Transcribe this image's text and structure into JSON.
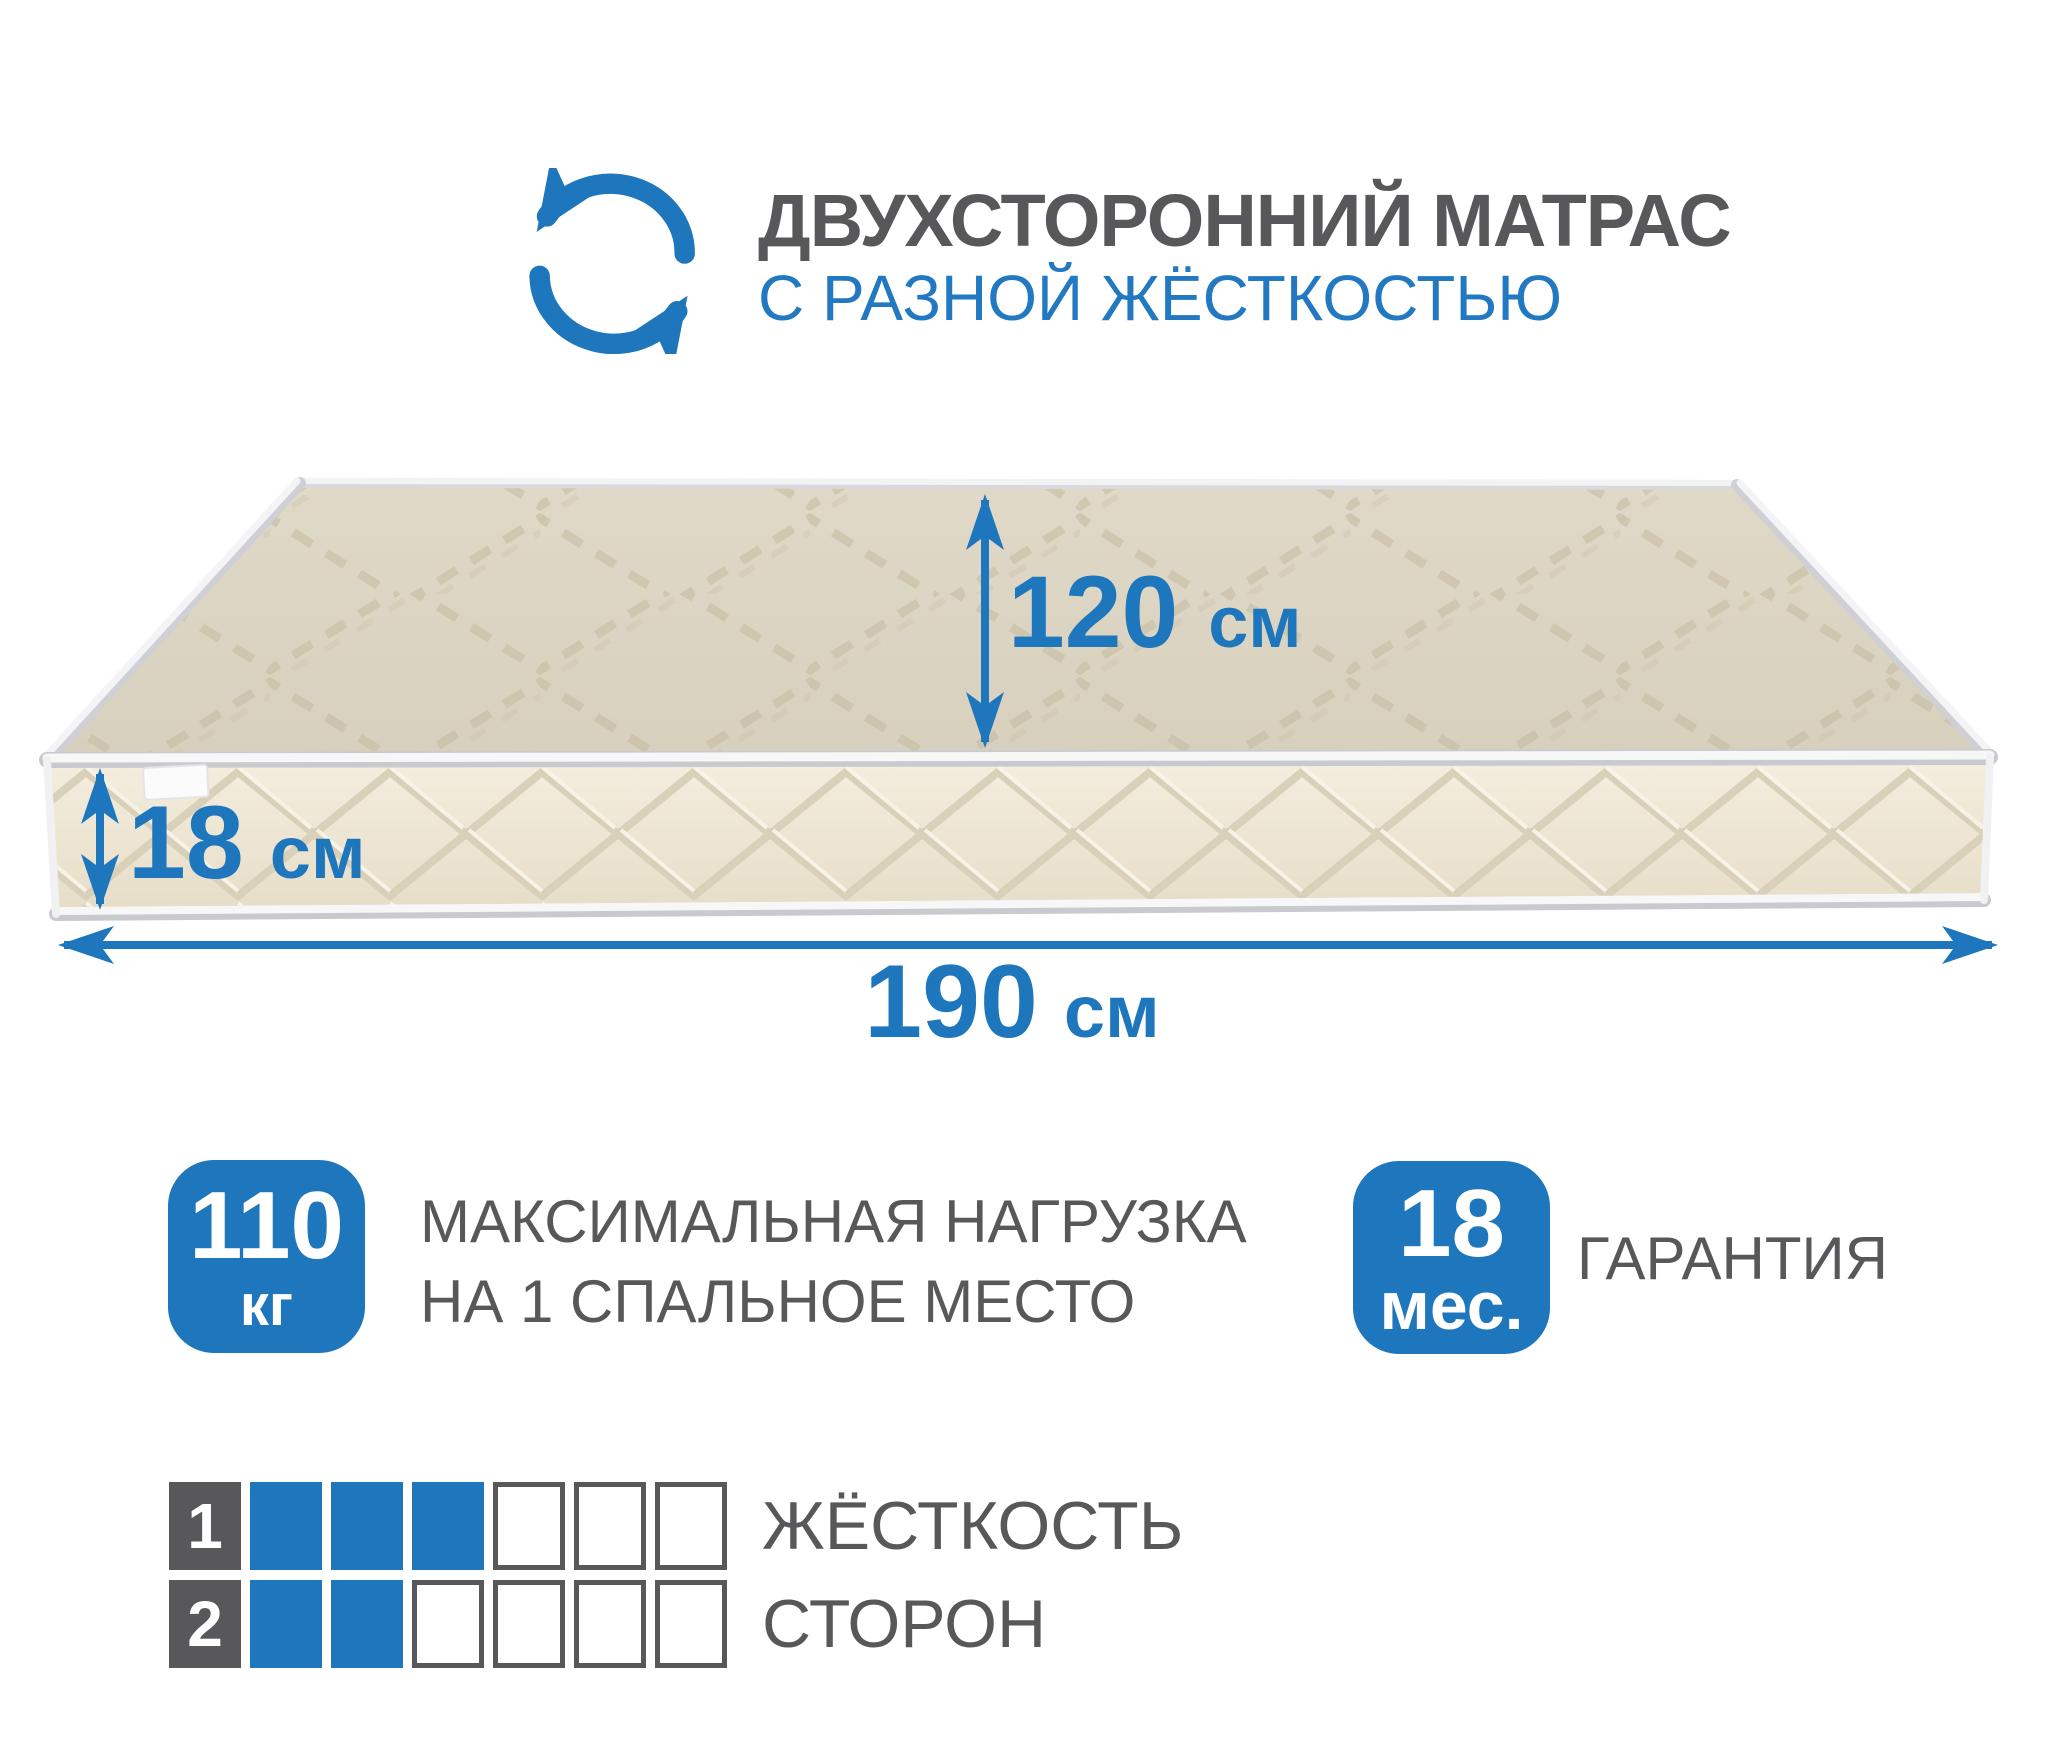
{
  "colors": {
    "accent_blue": "#1e76bd",
    "text_gray": "#58585a",
    "mattress_top": "#dbd4c2",
    "mattress_side": "#efe8d6",
    "piping_white": "#f6f6f7"
  },
  "header": {
    "icon": "rotate-arrows-icon",
    "title": "ДВУХСТОРОННИЙ МАТРАС",
    "subtitle": "С РАЗНОЙ ЖЁСТКОСТЬЮ"
  },
  "dimensions": {
    "depth": {
      "value": "120",
      "unit": "см"
    },
    "height": {
      "value": "18",
      "unit": "см"
    },
    "length": {
      "value": "190",
      "unit": "см"
    }
  },
  "badges": {
    "max_load": {
      "value": "110",
      "unit": "кг",
      "caption_line1": "МАКСИМАЛЬНАЯ НАГРУЗКА",
      "caption_line2": "НА 1 СПАЛЬНОЕ МЕСТО"
    },
    "warranty": {
      "value": "18",
      "unit": "мес.",
      "caption": "ГАРАНТИЯ"
    }
  },
  "firmness": {
    "caption_line1": "ЖЁСТКОСТЬ",
    "caption_line2": "СТОРОН",
    "rows": [
      {
        "label": "1",
        "filled": 3,
        "total": 6
      },
      {
        "label": "2",
        "filled": 2,
        "total": 6
      }
    ]
  }
}
